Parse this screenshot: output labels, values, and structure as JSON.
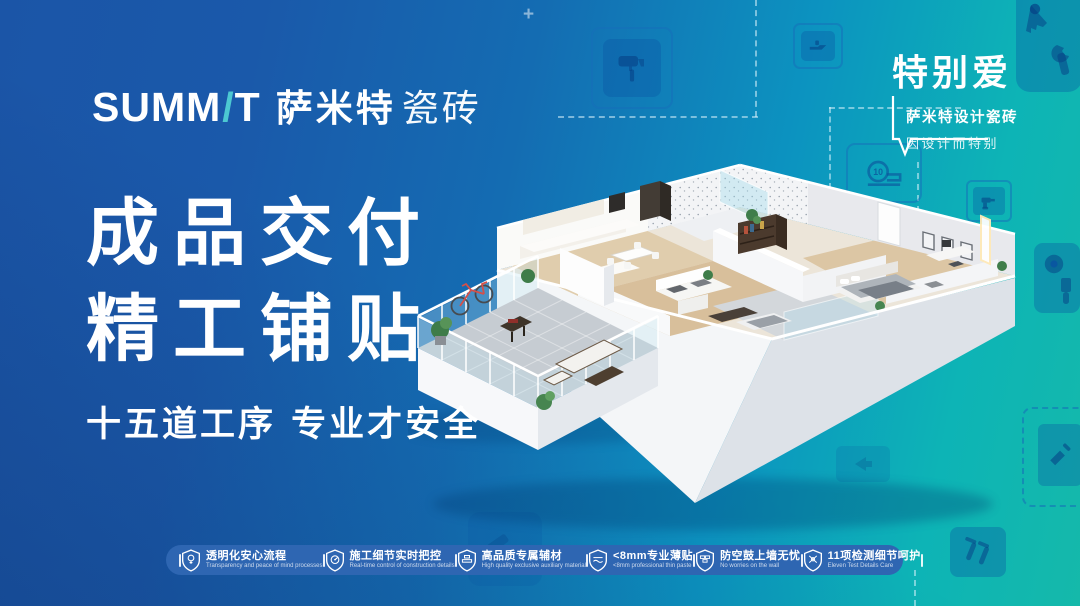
{
  "brand": {
    "name_en_prefix": "SUMM",
    "name_en_slash": "/",
    "name_en_suffix": "T",
    "name_cn_bold": "萨米特",
    "name_cn_light": "瓷砖"
  },
  "corner_badge": {
    "title": "特别爱",
    "subtitle": "萨米特设计瓷砖",
    "tagline": "因设计而特别"
  },
  "headline": {
    "line1": "成品交付",
    "line2": "精工铺贴",
    "subline": "十五道工序 专业才安全"
  },
  "features": [
    {
      "icon": "bulb-shield-icon",
      "zh": "透明化安心流程",
      "en": "Transparency and peace of mind processes"
    },
    {
      "icon": "monitor-shield-icon",
      "zh": "施工细节实时把控",
      "en": "Real-time control of construction details"
    },
    {
      "icon": "material-shield-icon",
      "zh": "高品质专属辅材",
      "en": "High quality exclusive auxiliary material"
    },
    {
      "icon": "thin-paste-shield-icon",
      "zh": "<8mm专业薄贴",
      "en": "<8mm professional thin paste"
    },
    {
      "icon": "wall-shield-icon",
      "zh": "防空鼓上墙无忧",
      "en": "No worries on the wall"
    },
    {
      "icon": "check-shield-icon",
      "zh": "11项检测细节呵护",
      "en": "Eleven Test Details Care"
    }
  ],
  "background": {
    "tape_measure_label": "10",
    "plus_mark": "+",
    "icon_names": [
      "paint-roller",
      "planer",
      "saw",
      "wrench",
      "tape-measure",
      "drill",
      "masking-tape",
      "paint-brush",
      "hammer",
      "screws",
      "trowel",
      "arrow"
    ]
  },
  "illustration": {
    "alt": "3D isometric cutaway of a furnished apartment with balcony"
  },
  "colors": {
    "gradient_left": "#1b55a7",
    "gradient_right": "#15b9aa",
    "accent_teal": "#4cc8d2",
    "footer_band": "#2e66b2",
    "text": "#ffffff"
  }
}
